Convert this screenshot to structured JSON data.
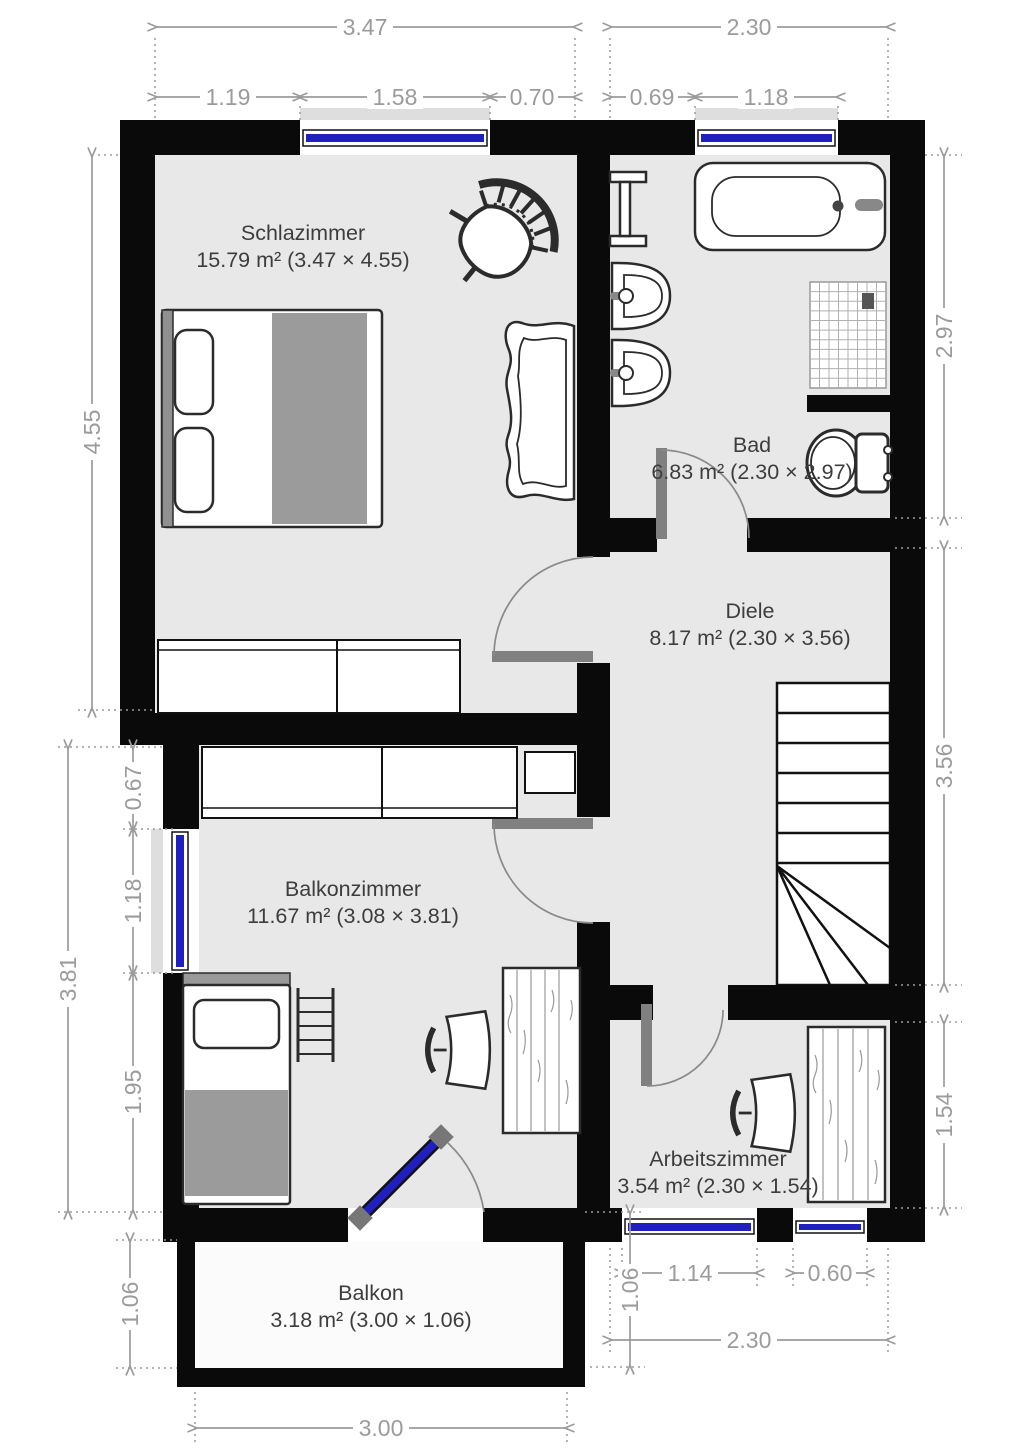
{
  "rooms": [
    {
      "name": "Schlazimmer",
      "area": "15.79 m² (3.47 × 4.55)"
    },
    {
      "name": "Bad",
      "area": "6.83 m² (2.30 × 2.97)"
    },
    {
      "name": "Diele",
      "area": "8.17 m² (2.30 × 3.56)"
    },
    {
      "name": "Balkonzimmer",
      "area": "11.67 m² (3.08 × 3.81)"
    },
    {
      "name": "Arbeitszimmer",
      "area": "3.54 m² (2.30 × 1.54)"
    },
    {
      "name": "Balkon",
      "area": "3.18 m² (3.00 × 1.06)"
    }
  ],
  "dims": {
    "top_left_total": "3.47",
    "top_left_a": "1.19",
    "top_left_b": "1.58",
    "top_left_c": "0.70",
    "top_right_total": "2.30",
    "top_right_a": "0.69",
    "top_right_b": "1.18",
    "left_bedroom": "4.55",
    "left_bz_total": "3.81",
    "left_bz_a": "0.67",
    "left_bz_b": "1.18",
    "left_bz_c": "1.95",
    "left_balcony": "1.06",
    "right_bath": "2.97",
    "right_hall": "3.56",
    "right_study": "1.54",
    "right_balcony": "1.06",
    "bottom_window_a": "1.14",
    "bottom_window_b": "0.60",
    "bottom_study": "2.30",
    "bottom_balcony": "3.00"
  },
  "colors": {
    "wall": "#0a0a0a",
    "floor": "#e8e8e8",
    "window_glass": "#2020c0",
    "door": "#808080",
    "dimension": "#9b9b9b",
    "label": "#3d3d3d"
  }
}
